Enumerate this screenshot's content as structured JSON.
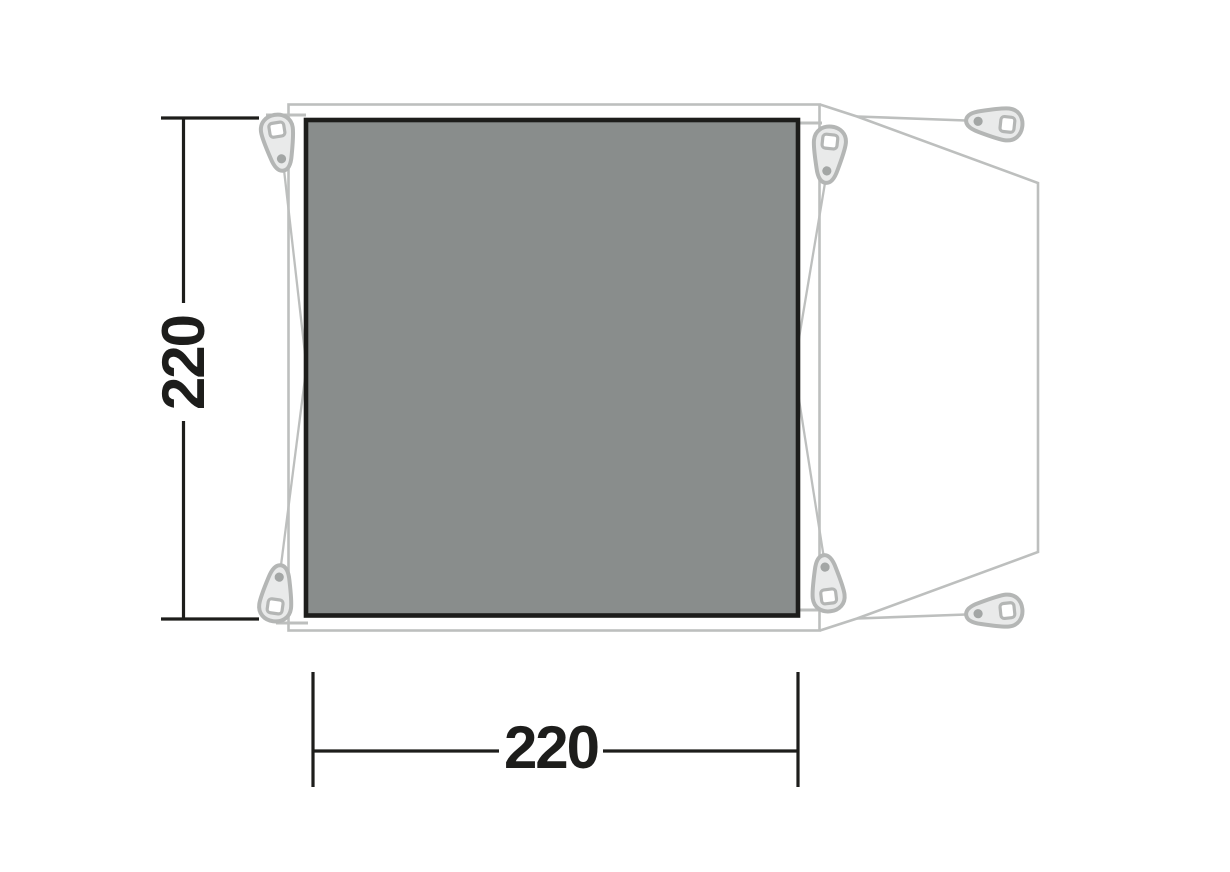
{
  "diagram": {
    "background_color": "#ffffff",
    "footprint": {
      "fill_color": "#898d8c",
      "border_color": "#1d1d1b"
    },
    "outline": {
      "color": "#bdbfbe"
    },
    "pegs": {
      "count": 6,
      "fill_color": "#e9eaea",
      "stroke_color": "#b4b6b5",
      "dot_color": "#a3a6a5"
    },
    "dimensions": {
      "text_color": "#1d1d1b",
      "height": {
        "value": "220"
      },
      "width": {
        "value": "220"
      }
    }
  }
}
